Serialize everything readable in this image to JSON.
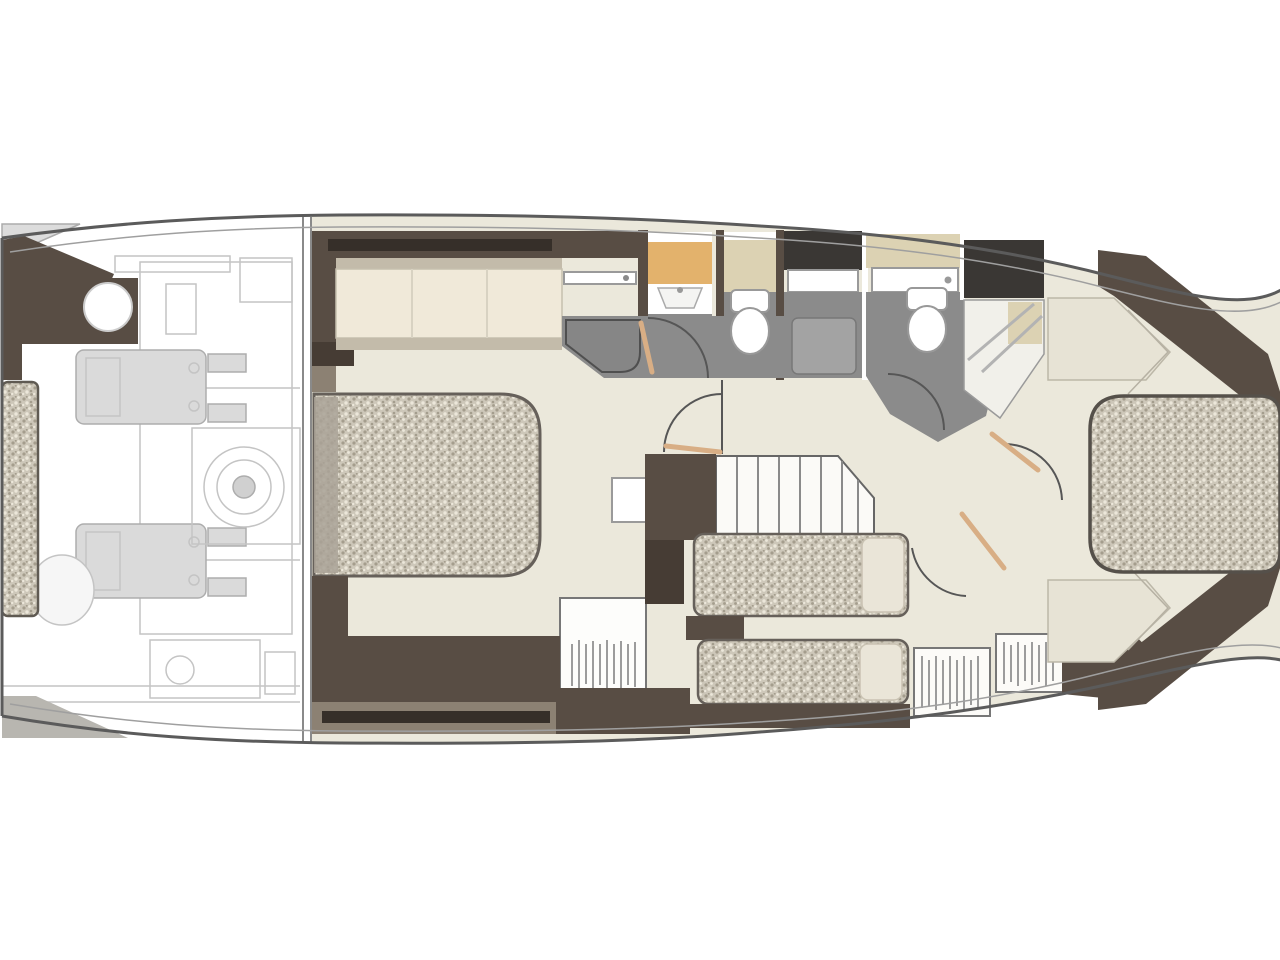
{
  "colors": {
    "wall": "#584d44",
    "wallDark": "#463c34",
    "slot": "#362f29",
    "taupe": "#8c8173",
    "floor": "#ebe8db",
    "bath": "#8b8b8b",
    "charcoal": "#3a3734",
    "tanCounter": "#e3b26c",
    "beigeCounter": "#dcd2b3",
    "cushion": "#f0e9d9",
    "cushionTrim": "#c3bbaa",
    "bedBase": "#cdc7b9",
    "bedDotDark": "#a49d8d",
    "bedDotLight": "#ece7da",
    "doorLeaf": "#d8ae85",
    "machine": "#dadada",
    "machineLine": "#adadad",
    "hullLine": "#5b5b5b",
    "hullInner": "#9f9f9f",
    "faintLine": "#c4c4c4",
    "showerFloor": "#f1f0ea",
    "insetGray": "#a3a3a3",
    "platformGray": "#b8b6b0"
  },
  "plan": {
    "type": "yacht-lower-deck-floor-plan",
    "orientation": "bow-right",
    "rooms": [
      "swim-platform",
      "engine-room",
      "port-guest-cabin",
      "mid-head",
      "corridor-with-stairs",
      "twin-guest-cabin",
      "forward-head",
      "bow-master-cabin"
    ],
    "fixtures": [
      "double-bed",
      "island-bed",
      "twin-beds",
      "sofa",
      "toilet",
      "shower",
      "vanity-sink",
      "hanging-locker",
      "wardrobe",
      "engines",
      "gearbox",
      "staircase",
      "door-swing"
    ]
  }
}
